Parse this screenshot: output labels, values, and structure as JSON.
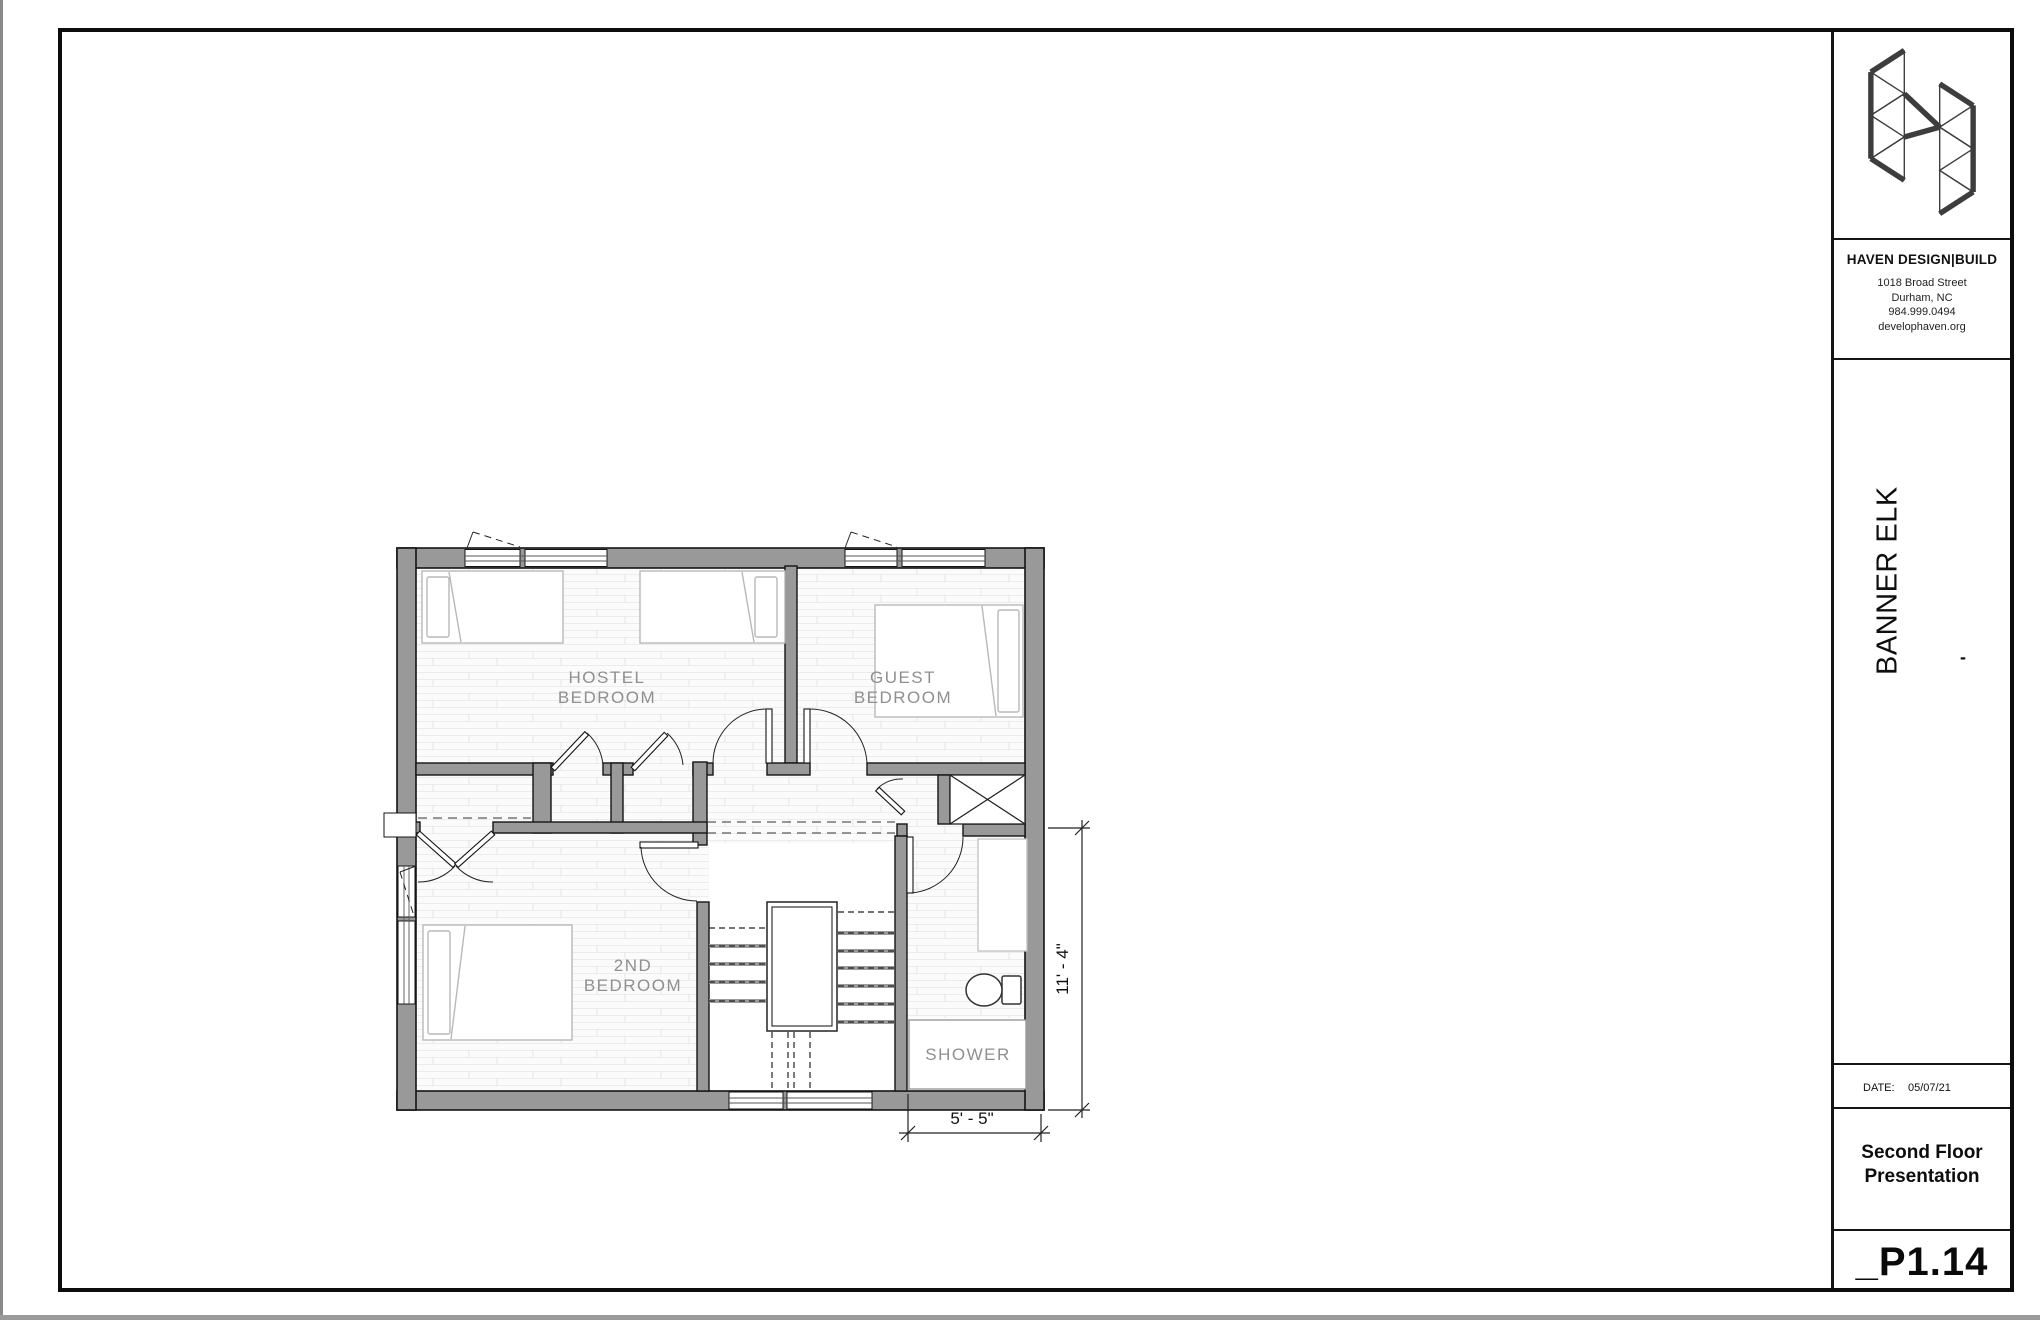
{
  "title_block": {
    "logo_icon": "haven-geometric-h-logo",
    "firm": "HAVEN DESIGN|BUILD",
    "address_line1": "1018 Broad Street",
    "address_line2": "Durham, NC",
    "phone": "984.999.0494",
    "website": "develophaven.org",
    "project": "BANNER ELK",
    "project_dash": "-",
    "date_label": "DATE:",
    "date_value": "05/07/21",
    "sheet_title_line1": "Second Floor",
    "sheet_title_line2": "Presentation",
    "sheet_number": "_P1.14"
  },
  "plan": {
    "rooms": [
      {
        "name": "hostel-bedroom",
        "line1": "HOSTEL",
        "line2": "BEDROOM"
      },
      {
        "name": "guest-bedroom",
        "line1": "GUEST",
        "line2": "BEDROOM"
      },
      {
        "name": "second-bedroom",
        "line1": "2ND",
        "line2": "BEDROOM"
      },
      {
        "name": "shower",
        "line1": "SHOWER",
        "line2": ""
      }
    ],
    "dimensions": {
      "vertical": "11' - 4\"",
      "horizontal": "5' - 5\""
    }
  },
  "colors": {
    "wall_fill": "#999999",
    "line_black": "#141414",
    "label_gray": "#8f8f8f",
    "furniture_gray": "#b8b8b8"
  }
}
